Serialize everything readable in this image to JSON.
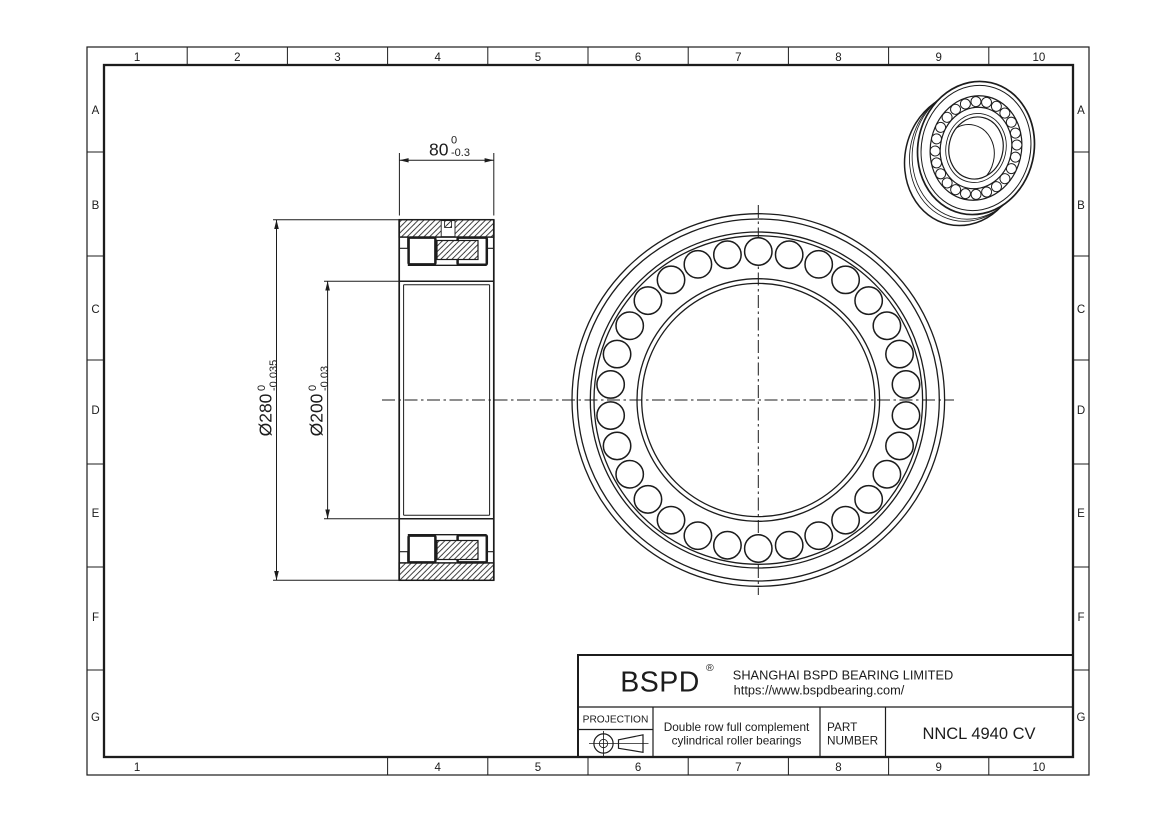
{
  "sheet": {
    "grid_columns_top": [
      "1",
      "2",
      "3",
      "4",
      "5",
      "6",
      "7",
      "8",
      "9",
      "10"
    ],
    "grid_columns_bottom": [
      "1",
      "4",
      "5",
      "6",
      "7",
      "8",
      "9",
      "10"
    ],
    "grid_rows": [
      "A",
      "B",
      "C",
      "D",
      "E",
      "F",
      "G"
    ]
  },
  "dimensions": {
    "width": {
      "value": "80",
      "tol_upper": "0",
      "tol_lower": "-0.3"
    },
    "outer_diameter": {
      "value": "Ø280",
      "tol_upper": "0",
      "tol_lower": "-0.035"
    },
    "bore_diameter": {
      "value": "Ø200",
      "tol_upper": "0",
      "tol_lower": "-0.03"
    }
  },
  "title_block": {
    "logo": "BSPD",
    "registered_mark": "®",
    "company": "SHANGHAI BSPD BEARING LIMITED",
    "website": "https://www.bspdbearing.com/",
    "projection_label": "PROJECTION",
    "description_line1": "Double row full complement",
    "description_line2": "cylindrical roller bearings",
    "part_label_line1": "PART",
    "part_label_line2": "NUMBER",
    "part_number": "NNCL 4940 CV"
  },
  "views": {
    "front_roller_count": 30,
    "iso_roller_count": 24
  },
  "colors": {
    "line": "#1c1c1c",
    "background": "#ffffff"
  }
}
